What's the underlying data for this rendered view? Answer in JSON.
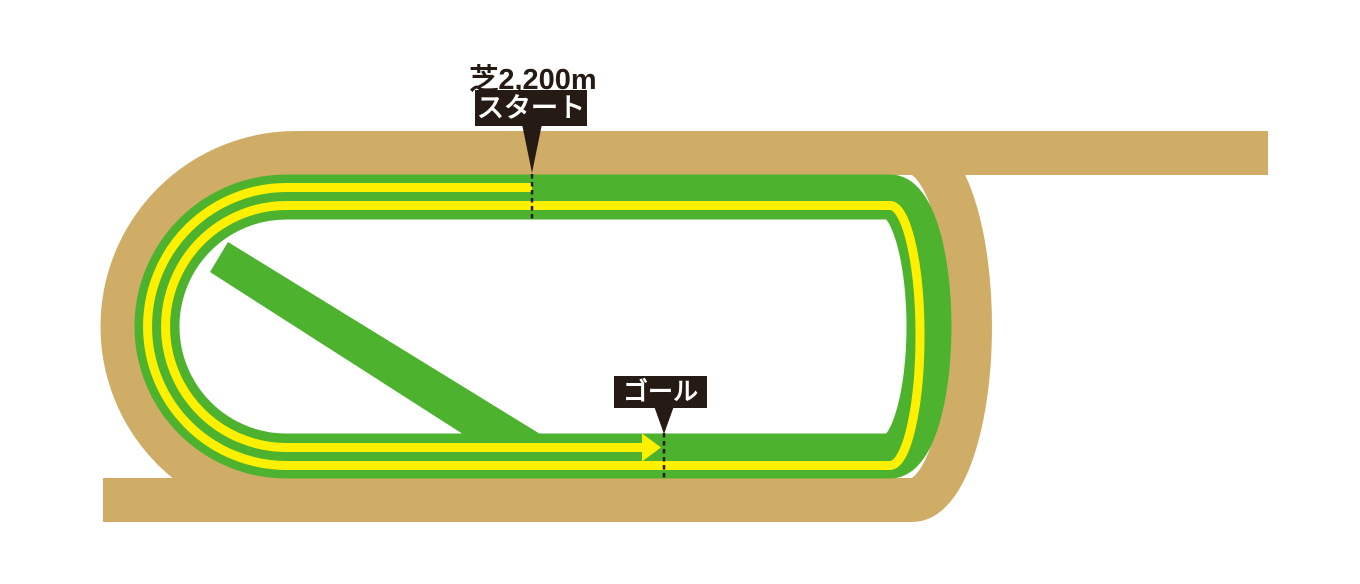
{
  "course_map": {
    "distance_label": "芝2,200m",
    "start_label": "スタート",
    "goal_label": "ゴール",
    "surface": "turf",
    "markers": {
      "start_line": "dashed",
      "goal_line": "dashed",
      "direction_arrow": "right"
    }
  },
  "colors": {
    "dirt_track": "#D0AD66",
    "turf_track": "#4DB32F",
    "route_line": "#FFF000",
    "marker_black": "#251B14",
    "label_bg": "#251B14",
    "label_text": "#FFFFFF",
    "background": "#FFFFFF"
  }
}
